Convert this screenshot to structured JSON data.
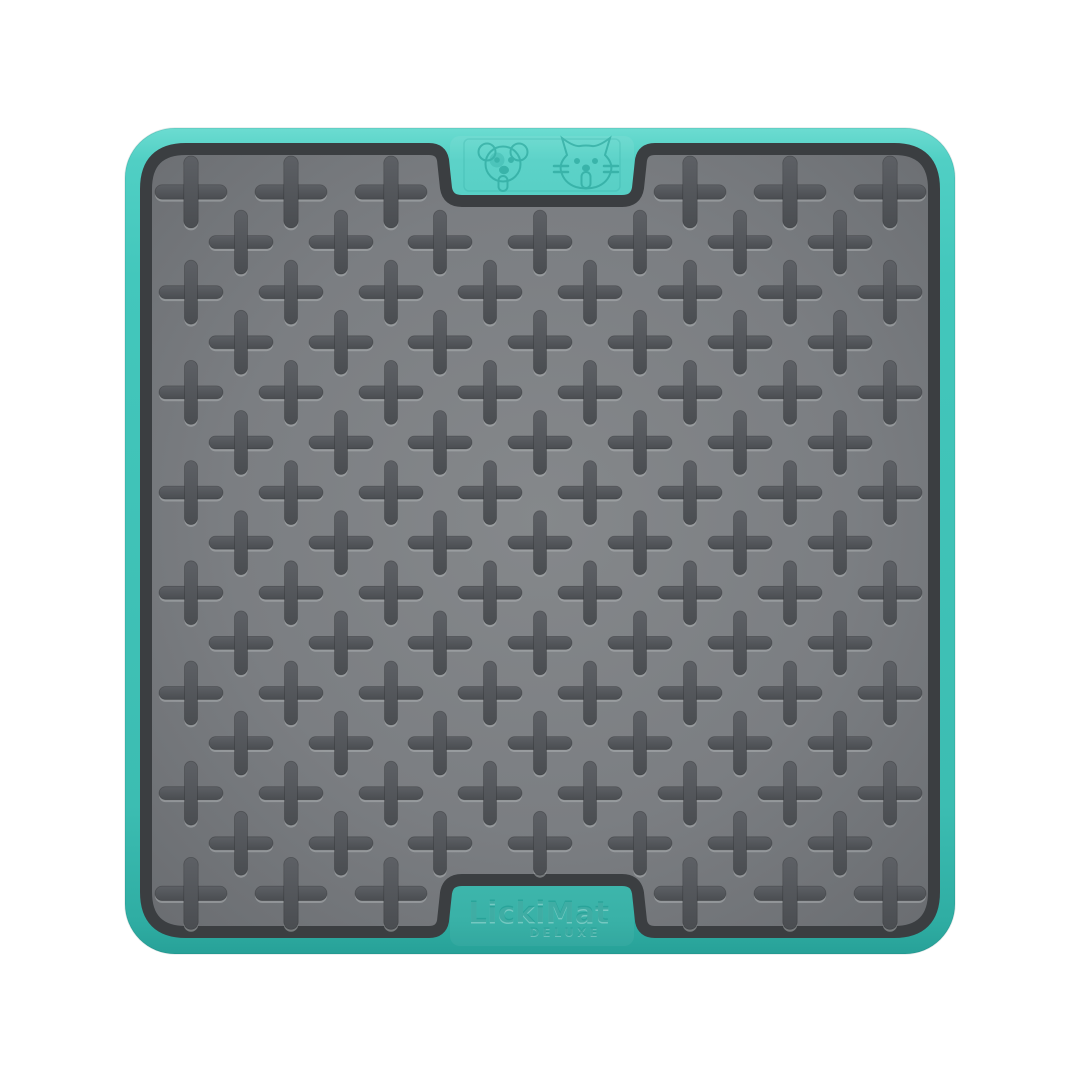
{
  "product": {
    "brand": "LickiMat",
    "variant": "DELUXE",
    "description": "Turquoise rubber pet lick mat with raised cross pattern, embossed dog and cat faces on top tab and brand name on bottom tab",
    "icons": [
      "dog-icon",
      "cat-icon"
    ]
  },
  "colors": {
    "background": "#ffffff",
    "teal_highlight": "#6cdcd1",
    "teal_light": "#50cfc4",
    "teal": "#43c7bc",
    "teal_mid": "#3cbdb2",
    "teal_dark": "#2fada3",
    "teal_deep": "#27a198",
    "rim": "#3b3e41",
    "mat_center": "#85888b",
    "mat_mid": "#7b7e82",
    "mat_edge": "#6a6d71",
    "cross_top": "#5d6065",
    "cross_bottom": "#4a4d51",
    "cross_highlight": "#b2b5b8",
    "emboss": "#1f9c92"
  },
  "pattern": {
    "row_count": 15,
    "first_row_y": 192,
    "row_step": 50.1,
    "odd_xs": [
      191,
      291,
      391,
      490,
      590,
      690,
      790,
      890
    ],
    "even_xs": [
      241,
      341,
      440,
      540,
      640,
      740,
      840
    ],
    "tab_skip_xs": [
      490,
      590
    ],
    "cross_span": 64,
    "cross_thickness": 13,
    "edge_cross_span": 72,
    "edge_cross_thickness": 14.5
  }
}
